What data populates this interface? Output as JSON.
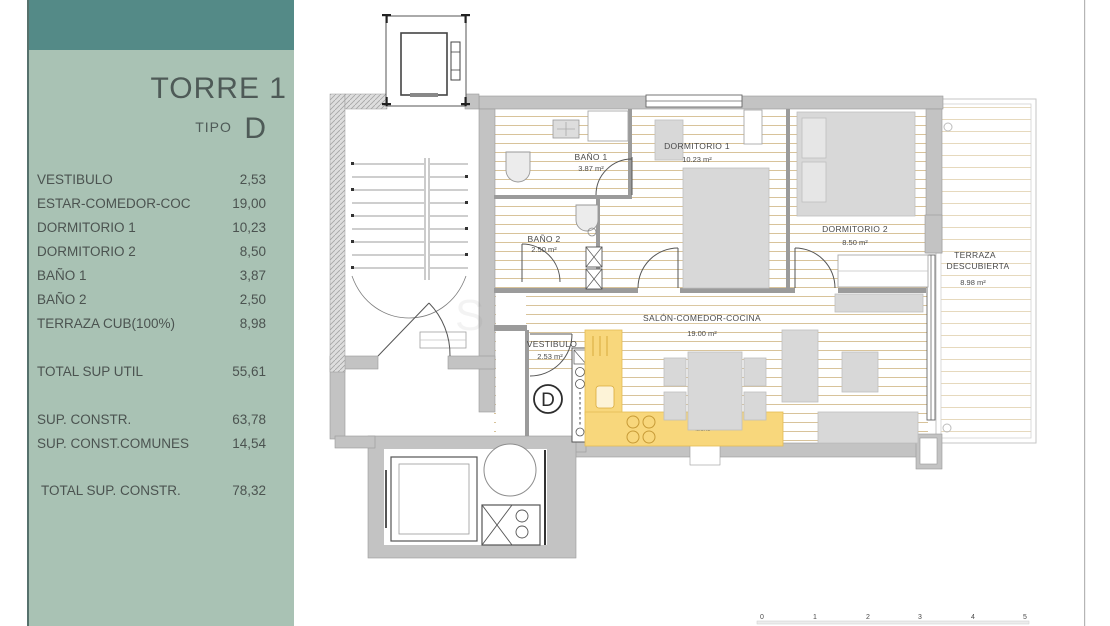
{
  "colors": {
    "header_band": "#548a87",
    "panel": "#a9c2b4",
    "sidebar_text": "#4b5350",
    "kitchen_yellow": "#f8d77c",
    "floor_line": "#d8c39a",
    "wall_gray": "#c3c3c3"
  },
  "sidebar": {
    "title": "TORRE 1",
    "tipo_label": "TIPO",
    "tipo_value": "D",
    "rooms": [
      {
        "label": "VESTIBULO",
        "value": "2,53"
      },
      {
        "label": "ESTAR-COMEDOR-COC",
        "value": "19,00"
      },
      {
        "label": "DORMITORIO 1",
        "value": "10,23"
      },
      {
        "label": "DORMITORIO 2",
        "value": "8,50"
      },
      {
        "label": "BAÑO 1",
        "value": "3,87"
      },
      {
        "label": "BAÑO 2",
        "value": "2,50"
      },
      {
        "label": "TERRAZA CUB(100%)",
        "value": "8,98"
      }
    ],
    "summary": {
      "total_util": {
        "label": "TOTAL SUP UTIL",
        "value": "55,61"
      },
      "sup_constr": {
        "label": "SUP. CONSTR.",
        "value": "63,78"
      },
      "sup_comunes": {
        "label": "SUP. CONST.COMUNES",
        "value": "14,54"
      },
      "total_constr": {
        "label": "TOTAL SUP. CONSTR.",
        "value": "78,32"
      }
    }
  },
  "plan": {
    "rooms": {
      "bano1": {
        "name": "BAÑO 1",
        "area": "3.87 m²"
      },
      "dormitorio1": {
        "name": "DORMITORIO 1",
        "area": "10.23 m²"
      },
      "dormitorio2": {
        "name": "DORMITORIO 2",
        "area": "8.50 m²"
      },
      "bano2": {
        "name": "BAÑO 2",
        "area": "2.50 m²"
      },
      "vestibulo": {
        "name": "VESTIBULO",
        "area": "2.53 m²"
      },
      "salon": {
        "name": "SALÓN-COMEDOR-COCINA",
        "area": "19.00 m²"
      },
      "terraza": {
        "name_line1": "TERRAZA",
        "name_line2": "DESCUBIERTA",
        "area": "8.98 m²"
      }
    },
    "unit_marker": "D",
    "kitchen_note": "MICRO",
    "scale_ticks": [
      "0",
      "1",
      "2",
      "3",
      "4",
      "5"
    ]
  }
}
